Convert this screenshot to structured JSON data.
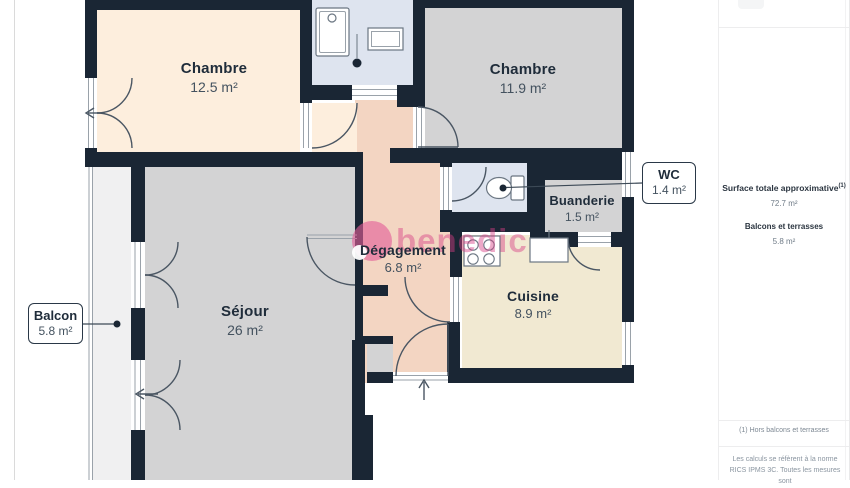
{
  "page": {
    "watermark": "benedic"
  },
  "plan": {
    "rooms": [
      {
        "key": "chambre-1",
        "label": "Chambre",
        "area": "12.5 m²"
      },
      {
        "key": "chambre-2",
        "label": "Chambre",
        "area": "11.9 m²"
      },
      {
        "key": "sejour",
        "label": "Séjour",
        "area": "26 m²"
      },
      {
        "key": "degagement",
        "label": "Dégagement",
        "area": "6.8 m²"
      },
      {
        "key": "cuisine",
        "label": "Cuisine",
        "area": "8.9 m²"
      },
      {
        "key": "buanderie",
        "label": "Buanderie",
        "area": "1.5 m²"
      }
    ],
    "callouts": [
      {
        "key": "wc",
        "label": "WC",
        "area": "1.4 m²"
      },
      {
        "key": "balcon",
        "label": "Balcon",
        "area": "5.8 m²"
      }
    ]
  },
  "sidebar": {
    "surface_title": "Surface totale approximative",
    "surface_title_sup": "(1)",
    "surface_value": "72.7 m²",
    "balconies_title": "Balcons et terrasses",
    "balconies_value": "5.8 m²",
    "footnote": "(1) Hors balcons et terrasses",
    "legal_line1": "Les calculs se réfèrent à la norme RICS",
    "legal_line2": "IPMS 3C. Toutes les mesures sont"
  },
  "colors": {
    "wall": "#1a2634",
    "room_warm": "#fdeedd",
    "room_grey": "#d3d3d4",
    "room_blue": "#dee4ef",
    "room_salmon": "#f3d5c2",
    "room_salmon_light": "#f6ddc9",
    "room_beige": "#f1e9d2",
    "balcony": "#f0f0f1",
    "watermark_pink": "#e25a96"
  }
}
